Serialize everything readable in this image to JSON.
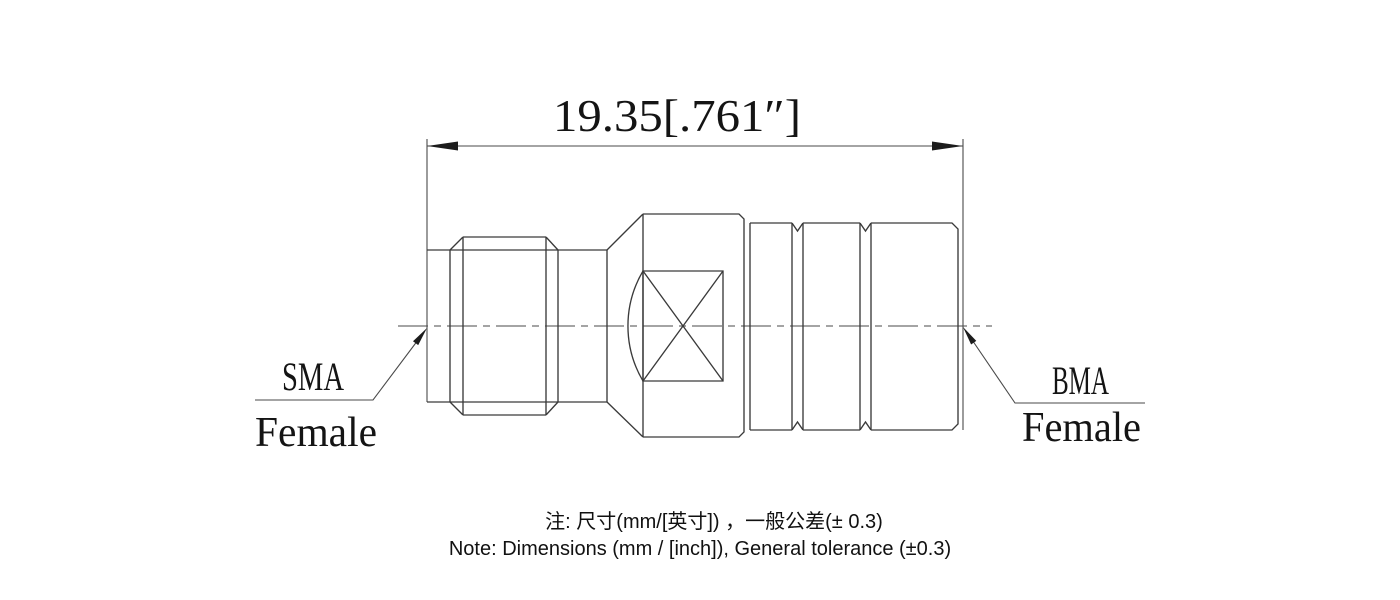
{
  "drawing": {
    "dimension_label": "19.35[.761″]",
    "labels": {
      "left_type": "SMA",
      "left_gender": "Female",
      "right_type": "BMA",
      "right_gender": "Female"
    },
    "notes": {
      "line1_zh": "注: 尺寸(mm/[英寸]) ，一般公差(± 0.3)",
      "line2_en": "Note: Dimensions (mm / [inch]), General tolerance (±0.3)"
    },
    "colors": {
      "line": "#3a3a3a",
      "text": "#141414",
      "background": "#ffffff"
    }
  }
}
